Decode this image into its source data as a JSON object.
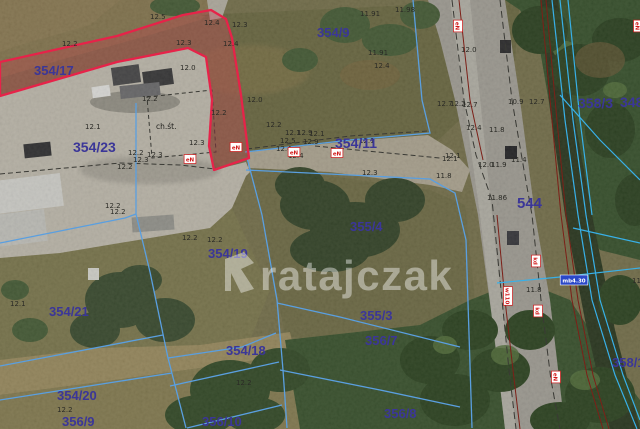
{
  "map": {
    "watermark": {
      "logo": "ratajczak-logo",
      "text": "ratajczak"
    },
    "building_annotation": {
      "text": "ch.śt.",
      "x": 167,
      "y": 127
    },
    "colors": {
      "parcel_label": "#3b3698",
      "highlight_parcel_stroke": "#e62349",
      "highlight_parcel_fill": "rgba(216,42,74,0.26)",
      "cadastral_line": "#5a9fe0",
      "ditch_line": "#38b0e8",
      "utility_maroon": "#7c2018",
      "badge_red": "#d01818",
      "badge_blue": "#2a48c8",
      "watermark": "#ffffff"
    },
    "parcel_labels": [
      {
        "text": "354/17",
        "x": 34,
        "y": 75,
        "fs": 13
      },
      {
        "text": "354/23",
        "x": 73,
        "y": 152,
        "fs": 14
      },
      {
        "text": "354/9",
        "x": 317,
        "y": 37,
        "fs": 13
      },
      {
        "text": "354/11",
        "x": 335,
        "y": 148,
        "fs": 14
      },
      {
        "text": "358/3",
        "x": 578,
        "y": 108,
        "fs": 14
      },
      {
        "text": "348",
        "x": 620,
        "y": 107,
        "fs": 14
      },
      {
        "text": "544",
        "x": 517,
        "y": 208,
        "fs": 15
      },
      {
        "text": "355/4",
        "x": 350,
        "y": 231,
        "fs": 13
      },
      {
        "text": "354/19",
        "x": 208,
        "y": 258,
        "fs": 13
      },
      {
        "text": "354/21",
        "x": 49,
        "y": 316,
        "fs": 13
      },
      {
        "text": "354/18",
        "x": 226,
        "y": 355,
        "fs": 13
      },
      {
        "text": "354/20",
        "x": 57,
        "y": 400,
        "fs": 13
      },
      {
        "text": "355/3",
        "x": 360,
        "y": 320,
        "fs": 13
      },
      {
        "text": "356/7",
        "x": 365,
        "y": 345,
        "fs": 13
      },
      {
        "text": "356/9",
        "x": 62,
        "y": 426,
        "fs": 13
      },
      {
        "text": "356/10",
        "x": 202,
        "y": 426,
        "fs": 13
      },
      {
        "text": "356/8",
        "x": 384,
        "y": 418,
        "fs": 13
      },
      {
        "text": "358/1",
        "x": 612,
        "y": 367,
        "fs": 13
      }
    ],
    "spot_elevations": [
      {
        "x": 62,
        "y": 46,
        "t": "12.2"
      },
      {
        "x": 150,
        "y": 19,
        "t": "12.5"
      },
      {
        "x": 204,
        "y": 25,
        "t": "12.4"
      },
      {
        "x": 232,
        "y": 27,
        "t": "12.3"
      },
      {
        "x": 176,
        "y": 45,
        "t": "12.3"
      },
      {
        "x": 223,
        "y": 46,
        "t": "12.4"
      },
      {
        "x": 180,
        "y": 70,
        "t": "12.0"
      },
      {
        "x": 142,
        "y": 101,
        "t": "12.2"
      },
      {
        "x": 85,
        "y": 129,
        "t": "12.1"
      },
      {
        "x": 211,
        "y": 115,
        "t": "12.2"
      },
      {
        "x": 189,
        "y": 145,
        "t": "12.3"
      },
      {
        "x": 128,
        "y": 155,
        "t": "12.2"
      },
      {
        "x": 147,
        "y": 157,
        "t": "12.3"
      },
      {
        "x": 133,
        "y": 162,
        "t": "12.3"
      },
      {
        "x": 117,
        "y": 169,
        "t": "12.2"
      },
      {
        "x": 105,
        "y": 208,
        "t": "12.2"
      },
      {
        "x": 110,
        "y": 214,
        "t": "12.2"
      },
      {
        "x": 247,
        "y": 102,
        "t": "12.0"
      },
      {
        "x": 266,
        "y": 127,
        "t": "12.2"
      },
      {
        "x": 285,
        "y": 135,
        "t": "12.1"
      },
      {
        "x": 297,
        "y": 135,
        "t": "12.9"
      },
      {
        "x": 309,
        "y": 136,
        "t": "12.1"
      },
      {
        "x": 280,
        "y": 143,
        "t": "12.5"
      },
      {
        "x": 303,
        "y": 144,
        "t": "12.9"
      },
      {
        "x": 359,
        "y": 143,
        "t": "12.1"
      },
      {
        "x": 276,
        "y": 151,
        "t": "12.4"
      },
      {
        "x": 288,
        "y": 158,
        "t": "12.4"
      },
      {
        "x": 362,
        "y": 175,
        "t": "12.3"
      },
      {
        "x": 442,
        "y": 161,
        "t": "12.1"
      },
      {
        "x": 436,
        "y": 178,
        "t": "11.8"
      },
      {
        "x": 437,
        "y": 106,
        "t": "12.7"
      },
      {
        "x": 450,
        "y": 106,
        "t": "12.2"
      },
      {
        "x": 462,
        "y": 107,
        "t": "12.7"
      },
      {
        "x": 508,
        "y": 104,
        "t": "10.9"
      },
      {
        "x": 529,
        "y": 104,
        "t": "12.7"
      },
      {
        "x": 466,
        "y": 130,
        "t": "12.4"
      },
      {
        "x": 489,
        "y": 132,
        "t": "11.8"
      },
      {
        "x": 445,
        "y": 158,
        "t": "12.1"
      },
      {
        "x": 478,
        "y": 167,
        "t": "12.0"
      },
      {
        "x": 491,
        "y": 167,
        "t": "11.9"
      },
      {
        "x": 511,
        "y": 162,
        "t": "11.4"
      },
      {
        "x": 487,
        "y": 200,
        "t": "11.86"
      },
      {
        "x": 526,
        "y": 292,
        "t": "11.8"
      },
      {
        "x": 360,
        "y": 16,
        "t": "11.91"
      },
      {
        "x": 395,
        "y": 12,
        "t": "11.98"
      },
      {
        "x": 368,
        "y": 55,
        "t": "11.91"
      },
      {
        "x": 461,
        "y": 52,
        "t": "12.0"
      },
      {
        "x": 374,
        "y": 68,
        "t": "12.4"
      },
      {
        "x": 10,
        "y": 306,
        "t": "12.1"
      },
      {
        "x": 57,
        "y": 412,
        "t": "12.2"
      },
      {
        "x": 236,
        "y": 385,
        "t": "12.2"
      },
      {
        "x": 182,
        "y": 240,
        "t": "12.2"
      },
      {
        "x": 207,
        "y": 242,
        "t": "12.2"
      },
      {
        "x": 632,
        "y": 283,
        "t": "11.1"
      }
    ],
    "utility_badges": [
      {
        "x": 236,
        "y": 147,
        "t": "eN",
        "rot": 0
      },
      {
        "x": 190,
        "y": 159,
        "t": "eN",
        "rot": 0
      },
      {
        "x": 294,
        "y": 152,
        "t": "eN",
        "rot": 0
      },
      {
        "x": 337,
        "y": 153,
        "t": "eN",
        "rot": 0
      },
      {
        "x": 458,
        "y": 26,
        "t": "eN",
        "rot": 90
      },
      {
        "x": 508,
        "y": 296,
        "t": "w110",
        "rot": 90
      },
      {
        "x": 536,
        "y": 261,
        "t": "kd",
        "rot": 90
      },
      {
        "x": 538,
        "y": 311,
        "t": "kd",
        "rot": 90
      },
      {
        "x": 556,
        "y": 377,
        "t": "eN",
        "rot": 90
      },
      {
        "x": 638,
        "y": 26,
        "t": "eN",
        "rot": 90
      }
    ],
    "culvert_badge": {
      "x": 574,
      "y": 280,
      "t": "mb4.30"
    }
  }
}
